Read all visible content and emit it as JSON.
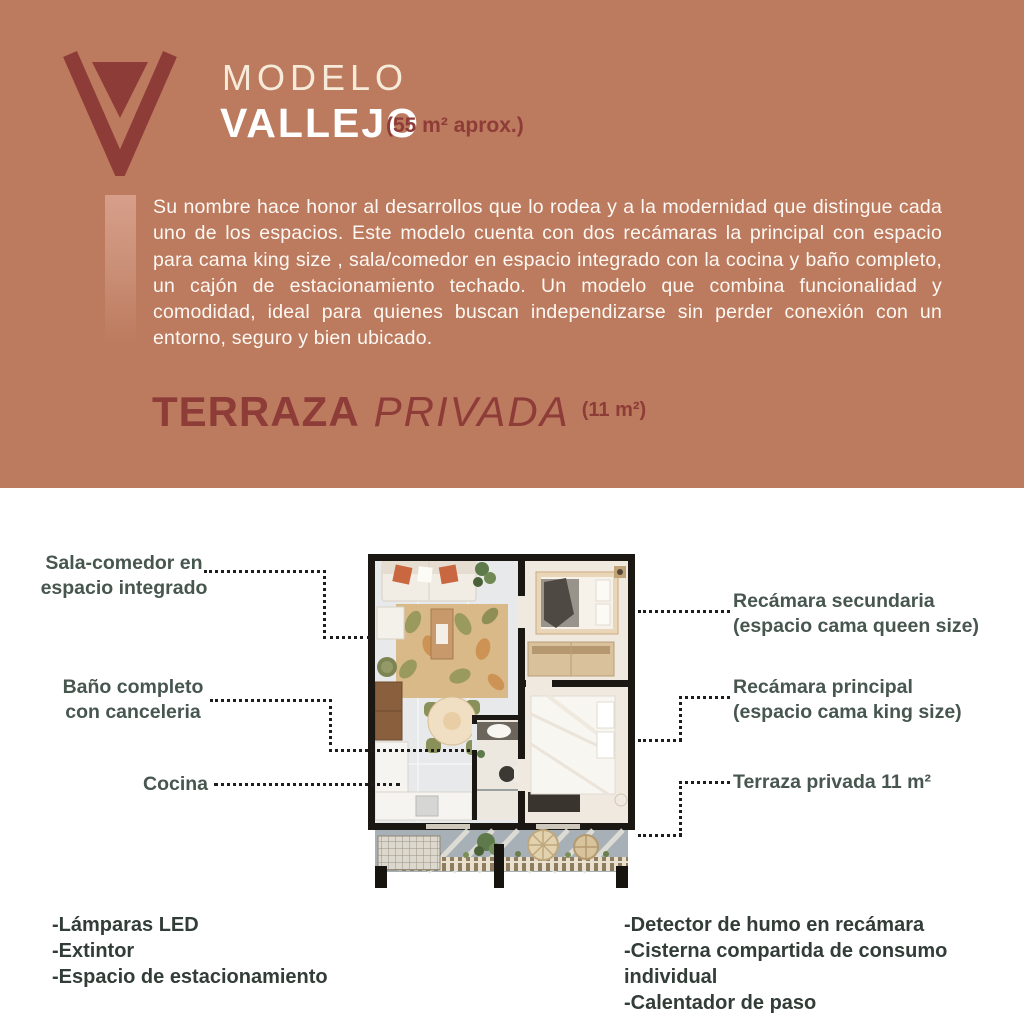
{
  "header": {
    "brand_logo": "v-logo",
    "model_label": "MODELO",
    "model_name": "VALLEJO",
    "area_note": "(55 m² aprox.)",
    "description": "Su nombre hace honor al desarrollos que lo rodea y a la modernidad que distingue cada uno de los espacios. Este modelo cuenta con dos recámaras la principal con espacio para cama king size , sala/comedor en espacio integrado con la cocina y baño completo, un cajón de estacionamiento techado. Un modelo que combina funcionalidad y comodidad, ideal para quienes buscan independizarse sin perder conexión con un entorno, seguro y bien ubicado.",
    "terrace_word1": "TERRAZA",
    "terrace_word2": "PRIVADA",
    "terrace_area": "(11 m²)"
  },
  "callouts": {
    "sala": {
      "line1": "Sala-comedor en",
      "line2": "espacio integrado"
    },
    "bano": {
      "line1": "Baño completo",
      "line2": "con canceleria"
    },
    "cocina": {
      "line1": "Cocina"
    },
    "secundaria": {
      "line1": "Recámara secundaria",
      "line2": "(espacio cama queen size)"
    },
    "principal": {
      "line1": "Recámara principal",
      "line2": "(espacio cama king size)"
    },
    "terraza": {
      "line1": "Terraza privada 11 m²"
    }
  },
  "features": {
    "left": [
      "-Lámparas LED",
      "-Extintor",
      "-Espacio de estacionamiento"
    ],
    "right": [
      "-Detector de humo en recámara",
      "-Cisterna compartida de consumo individual",
      "-Calentador de paso"
    ]
  },
  "colors": {
    "terracotta": "#bc7a5e",
    "maroon": "#8e3c38",
    "cream_text": "#f6ead9",
    "callout_text": "#47564f",
    "list_text": "#333d38",
    "dots": "#1d1d1d"
  }
}
